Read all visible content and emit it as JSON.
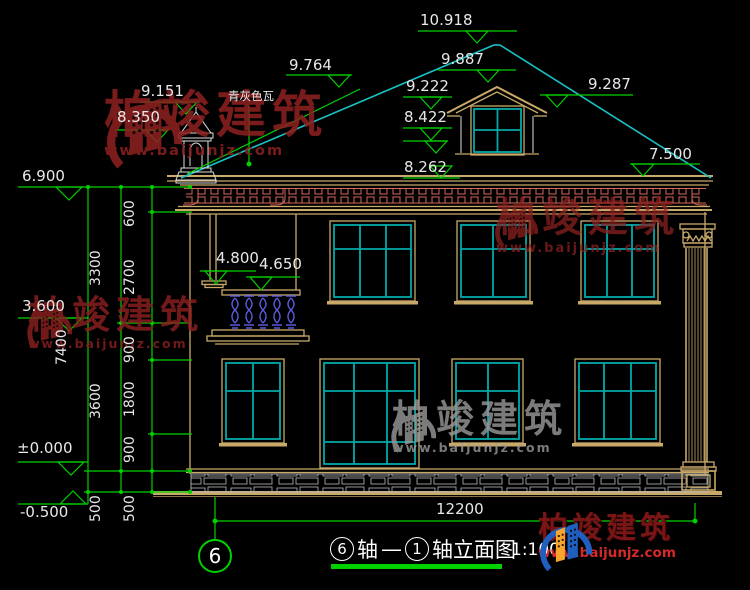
{
  "title_block": {
    "bubble_left": "6",
    "axis_word": "轴",
    "dash": "—",
    "bubble_right": "1",
    "suffix": "轴立面图",
    "scale": "1:100",
    "grid_bubble": "6"
  },
  "labels": {
    "roof_material": "青灰色瓦"
  },
  "elevations": {
    "ridge": "10.918",
    "dormer_ridge": "9.887",
    "slope_left": "9.764",
    "dormer_eave": "9.222",
    "slope_right": "9.287",
    "dormer_sill": "8.422",
    "eave_top": "8.262",
    "eave_right": "7.500",
    "cupola_top": "9.151",
    "cupola_base": "8.350",
    "wall_top": "6.900",
    "floor2": "3.600",
    "ground": "±0.000",
    "site": "-0.500",
    "balcony_cap": "4.800",
    "balcony_rail": "4.650"
  },
  "dimensions": {
    "total_height": "7400",
    "upper_band": "600",
    "f2_total": "3300",
    "f2_window_zone": "2700",
    "spandrel": "900",
    "f1_total": "3600",
    "f1_window_zone": "1800",
    "f1_sill": "900",
    "plinth_a": "500",
    "plinth_b": "500",
    "total_width": "12200"
  },
  "watermark": {
    "brand": "柏竣建筑",
    "url": "www.baijunjz.com"
  },
  "logo": {
    "brand": "柏竣建筑",
    "url": "www.baijunjz.com"
  },
  "colors": {
    "background": "#000000",
    "dimension_green": "#00d200",
    "drawing_tan": "#c9a96a",
    "window_teal": "#00a9a9",
    "cornice_red": "#d4695a",
    "baluster_blue": "#5a5ae0",
    "stone_gray": "#b8b8b8",
    "text_white": "#e8e8e8",
    "watermark_red": "#8c2020",
    "watermark_gray": "#9a9a9a",
    "logo_blue": "#1f5fbf",
    "logo_orange": "#f7a52b",
    "logo_text_red": "#7a1515",
    "logo_url_red": "#d42a2a"
  }
}
